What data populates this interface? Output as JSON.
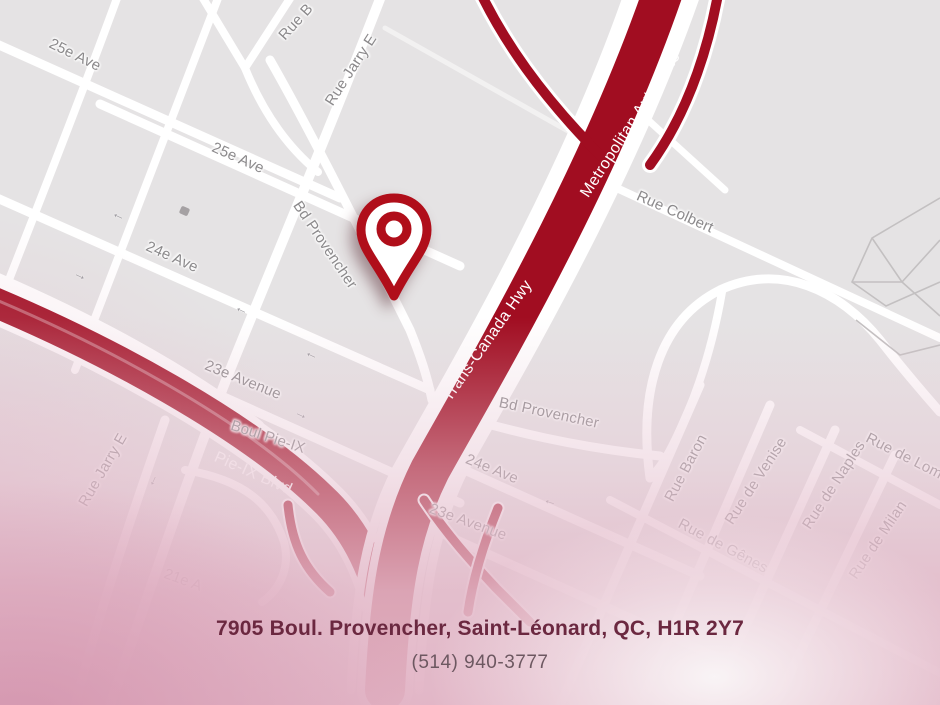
{
  "map": {
    "street_labels": [
      {
        "id": "25e-ave-nw",
        "text": "25e Ave"
      },
      {
        "id": "25e-ave-mid",
        "text": "25e Ave"
      },
      {
        "id": "24e-ave-left",
        "text": "24e Ave"
      },
      {
        "id": "23e-avenue-left",
        "text": "23e Avenue"
      },
      {
        "id": "boul-pie-ix",
        "text": "Boul Pie-IX"
      },
      {
        "id": "21e-ave-faint",
        "text": "21e A"
      },
      {
        "id": "rue-jarry-e-top",
        "text": "Rue Jarry E"
      },
      {
        "id": "rue-jarry-e-left",
        "text": "Rue Jarry E"
      },
      {
        "id": "rue-b-cut",
        "text": "Rue B"
      },
      {
        "id": "bd-provencher-west",
        "text": "Bd Provencher"
      },
      {
        "id": "rue-colbert",
        "text": "Rue Colbert"
      },
      {
        "id": "bd-provencher-east",
        "text": "Bd Provencher"
      },
      {
        "id": "24e-ave-right",
        "text": "24e Ave"
      },
      {
        "id": "23e-avenue-right",
        "text": "23e Avenue"
      },
      {
        "id": "rue-baron",
        "text": "Rue Baron"
      },
      {
        "id": "rue-de-venise",
        "text": "Rue de Venise"
      },
      {
        "id": "rue-de-naples",
        "text": "Rue de Naples"
      },
      {
        "id": "rue-de-genes",
        "text": "Rue de Gênes"
      },
      {
        "id": "rue-de-milan",
        "text": "Rue de Milan"
      },
      {
        "id": "rue-de-lombardie",
        "text": "Rue de Lomb"
      }
    ],
    "highway_labels": [
      {
        "id": "metropolitan-autoroute",
        "text": "Metropolitan Autoroute"
      },
      {
        "id": "trans-canada-hwy",
        "text": "Trans-Canada Hwy"
      },
      {
        "id": "pie-ix-blvd",
        "text": "Pie-IX Blvd"
      }
    ],
    "pin": {
      "name": "location-pin",
      "color": "#b00e1a"
    }
  },
  "icons": {
    "one_way_arrow": "→"
  },
  "colors": {
    "map_background": "#e5e3e4",
    "road_white": "#ffffff",
    "highway_red": "#a10d21",
    "street_label_gray": "#8b898b",
    "highway_label_white": "#ffffff",
    "address_maroon": "#6b2840",
    "phone_gray": "#6d5861",
    "fog_pink": "#e2b5c6"
  },
  "footer": {
    "address": "7905 Boul. Provencher, Saint-Léonard, QC, H1R 2Y7",
    "phone": "(514) 940-3777"
  }
}
